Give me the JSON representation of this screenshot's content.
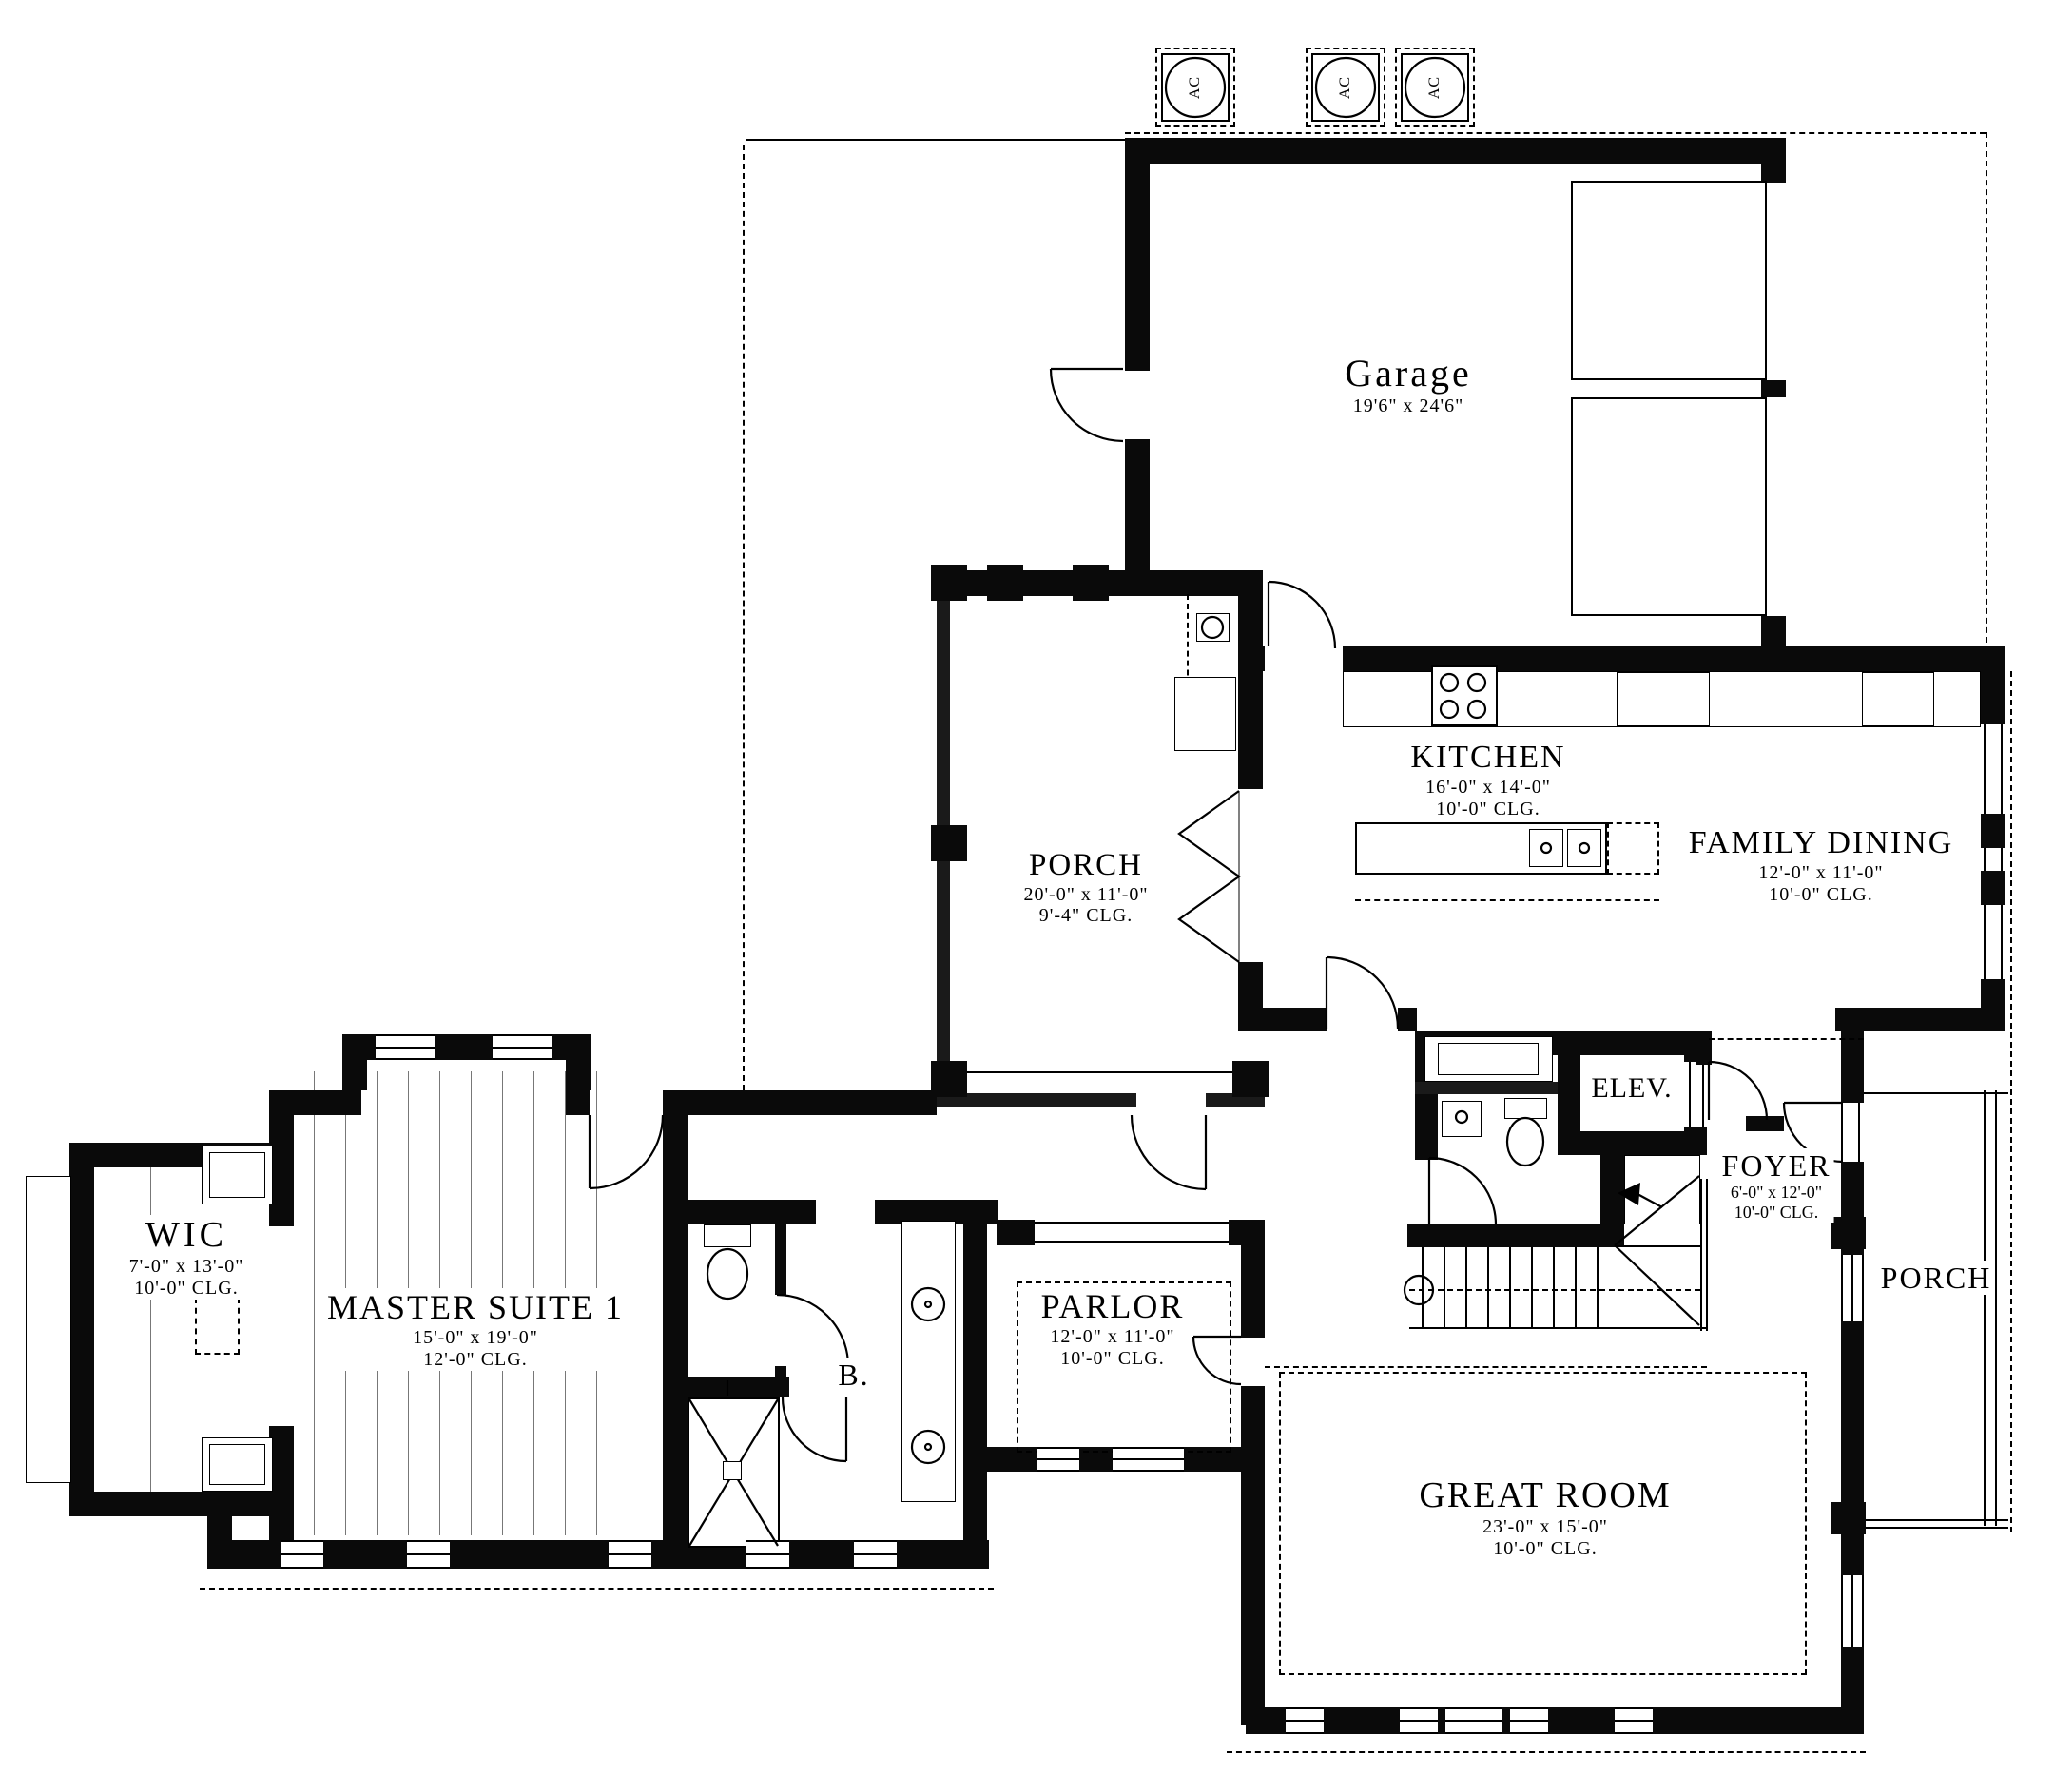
{
  "plan": {
    "rooms": {
      "garage": {
        "name": "Garage",
        "dims": "19'6\" x 24'6\""
      },
      "kitchen": {
        "name": "KITCHEN",
        "dims": "16'-0\" x 14'-0\"",
        "clg": "10'-0\" CLG."
      },
      "family_dining": {
        "name": "FAMILY DINING",
        "dims": "12'-0\" x 11'-0\"",
        "clg": "10'-0\" CLG."
      },
      "porch_rear": {
        "name": "PORCH",
        "dims": "20'-0\" x 11'-0\"",
        "clg": "9'-4\" CLG."
      },
      "master_suite": {
        "name": "MASTER SUITE 1",
        "dims": "15'-0\" x 19'-0\"",
        "clg": "12'-0\" CLG."
      },
      "wic": {
        "name": "WIC",
        "dims": "7'-0\" x 13'-0\"",
        "clg": "10'-0\" CLG."
      },
      "parlor": {
        "name": "PARLOR",
        "dims": "12'-0\" x 11'-0\"",
        "clg": "10'-0\" CLG."
      },
      "bath": {
        "name": "B."
      },
      "elevator": {
        "name": "ELEV."
      },
      "foyer": {
        "name": "FOYER",
        "dims": "6'-0\" x 12'-0\"",
        "clg": "10'-0\" CLG."
      },
      "porch_front": {
        "name": "PORCH"
      },
      "great_room": {
        "name": "GREAT ROOM",
        "dims": "23'-0\" x 15'-0\"",
        "clg": "10'-0\" CLG."
      }
    },
    "equipment": {
      "ac1": "AC",
      "ac2": "AC",
      "ac3": "AC"
    },
    "colors": {
      "ink": "#000000",
      "paper": "#ffffff"
    }
  }
}
